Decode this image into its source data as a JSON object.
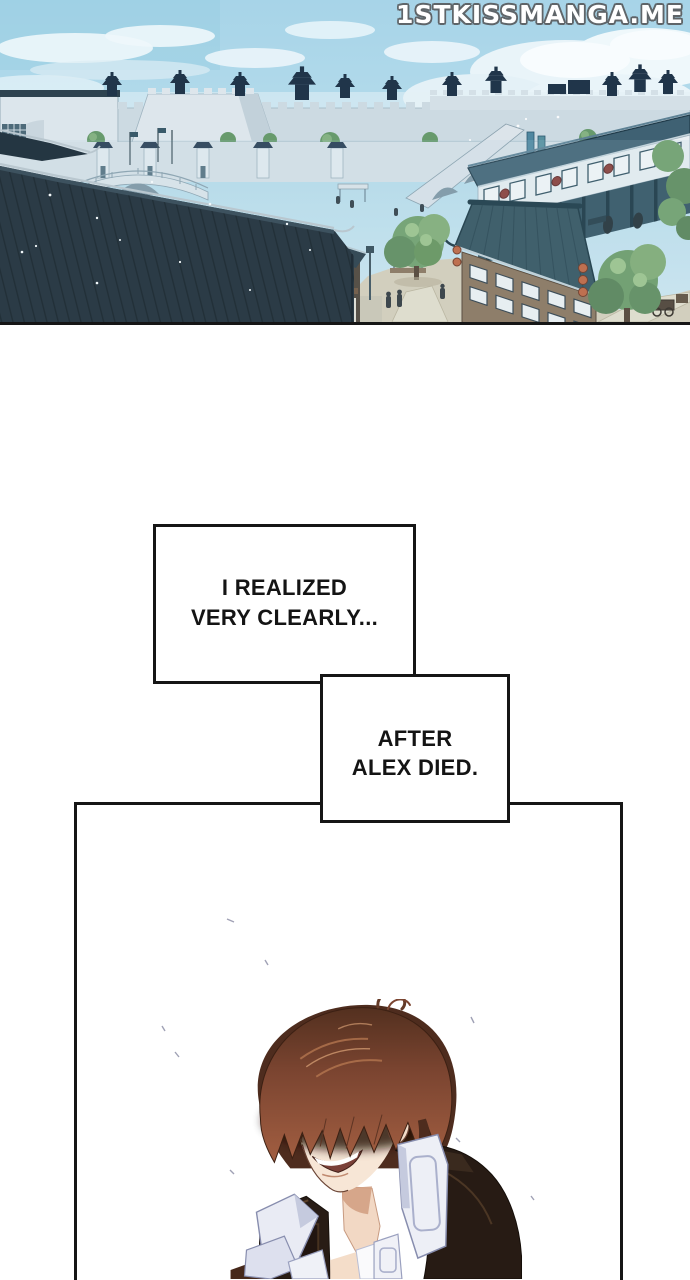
{
  "site_watermark": {
    "text": "1STKISSMANGA.ME"
  },
  "captions": {
    "box1": {
      "line1": "I REALIZED",
      "line2": "VERY CLEARLY..."
    },
    "box2": {
      "line1": "AFTER",
      "line2": "ALEX DIED."
    }
  },
  "panels": {
    "scenery": {
      "alt": "Aerial view of an ancient East-Asian walled town: dark pagoda towers on white ramparts under a blue cloudy sky, stone arched bridges, a teal-roofed market street with red emblems, green trees, a sandy plaza with tiny townsfolk and lantern-hung wooden buildings, and a large dark tiled roof filling the left foreground"
    },
    "character": {
      "alt": "Young man with shaggy brown hair shadowing his closed eyes, grinning widely, wearing a black high-collared coat with pale lavender-white collar flaps and a black stud earring"
    }
  },
  "colors": {
    "page_background": "#ffffff",
    "panel_border": "#161616",
    "caption_text": "#141414",
    "watermark_fill": "#ffffff",
    "watermark_outline": "#5f6569",
    "sky_top": "#a7d4e8",
    "sky_bottom": "#d3eaf3",
    "distant_silhouette": "#20354a",
    "foreground_roof": "#2b3b46",
    "market_roof": "#3f6173",
    "restaurant_roof": "#2f4e5a",
    "wood_wall": "#8a7158",
    "tree_green": "#6f9f68",
    "ground_sand": "#d9d0ba",
    "lantern_orange": "#c2613a",
    "emblem_red": "#8a3a34",
    "hair_brown": "#7a4430",
    "skin": "#f7e6d6",
    "jacket_dark": "#271b14",
    "collar_white": "#edeff6"
  }
}
